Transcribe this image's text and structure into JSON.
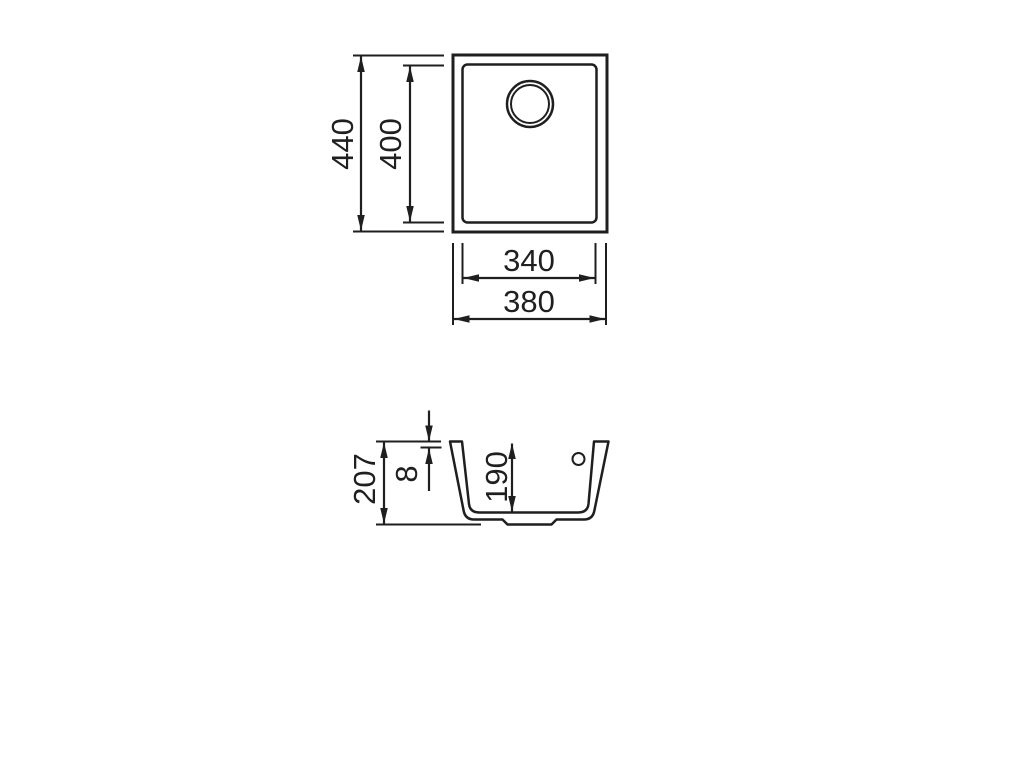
{
  "drawing": {
    "background": "#ffffff",
    "line_color": "#1f1f1f",
    "type": "sink technical drawing, plan view and section view",
    "plan_view": {
      "overall_height": "440",
      "bowl_height": "400",
      "bowl_width": "340",
      "overall_width": "380"
    },
    "section_view": {
      "overall_depth": "207",
      "rim_height": "8",
      "bowl_depth": "190"
    }
  }
}
